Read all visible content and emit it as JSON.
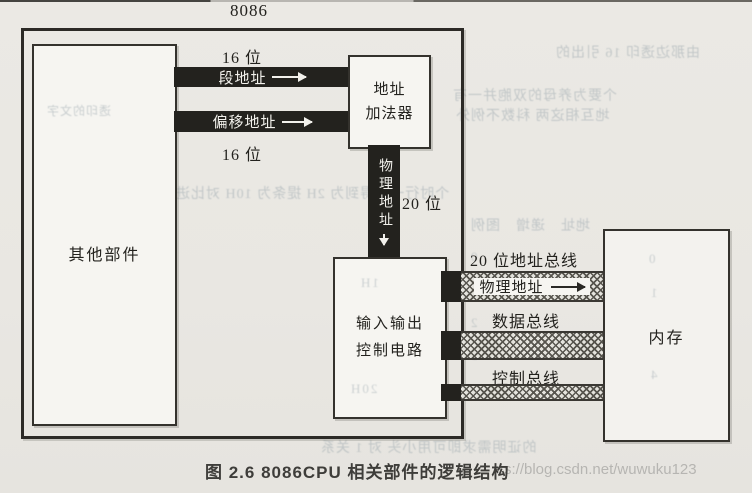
{
  "header": {
    "chip_label": "8086"
  },
  "cpu": {
    "other_components_label": "其他部件",
    "bit_width_top": "16 位",
    "bit_width_bottom": "16 位",
    "segment_address_label": "段地址",
    "offset_address_label": "偏移地址",
    "adder_line1": "地址",
    "adder_line2": "加法器",
    "physical_address_vertical": "物理地址",
    "bit_width_physical": "20 位",
    "io_line1": "输入输出",
    "io_line2": "控制电路"
  },
  "buses": {
    "address_bus_title": "20 位地址总线",
    "address_bus_inner_label": "物理地址",
    "data_bus_title": "数据总线",
    "control_bus_title": "控制总线"
  },
  "memory": {
    "label": "内存"
  },
  "footer": {
    "caption": "图 2.6   8086CPU 相关部件的逻辑结构",
    "watermark": "s://blog.csdn.net/wuwuku123"
  },
  "colors": {
    "page_bg": "#e9e7e2",
    "box_fill": "#f6f5f1",
    "border": "#34322d",
    "bar_dark": "#23221e",
    "hatch": "#57554e",
    "caption_text": "#3e3d3a",
    "watermark_gray": "#b6b5b2",
    "bleed_gray_blue": "#9aa6ad"
  },
  "bleed_through": {
    "line1": "由那边透印 16 引出的",
    "line2": "个要为养母的双胞并一有",
    "line3": "地互相这两 科数不例外",
    "line4": "个时行一个得到为 2H 提条为 10H 对比进行",
    "line5": "地址　递增　图例",
    "line6": "的证明需求即可用小头 对 1 关系",
    "left_box_line": "透印的文字",
    "col_a": [
      "0",
      "1",
      "2",
      "3",
      "4"
    ],
    "io_mark1": "1H",
    "io_mark2": "20H",
    "mem_marks": [
      "0",
      "1",
      "4"
    ]
  }
}
